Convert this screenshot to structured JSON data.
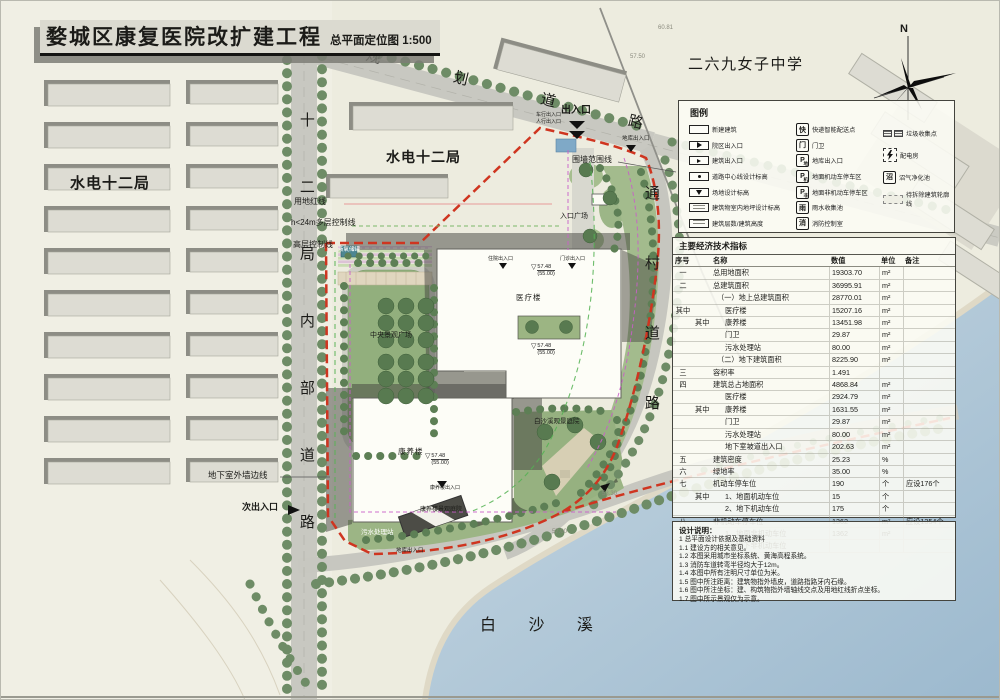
{
  "title": {
    "main": "婺城区康复医院改扩建工程",
    "sub": "总平面定位图 1:500"
  },
  "compass_label": "N",
  "map": {
    "areas": {
      "school": "二六九女子中学",
      "bureau_left": "水电十二局",
      "bureau_mid": "水电十二局",
      "river": "白 沙 溪",
      "planned_road": "规划道路",
      "internal_road": "十二局内部道路",
      "village_road": "通村道路"
    },
    "labels": {
      "main_entry": "出入口",
      "secondary_entry": "次出入口",
      "fence_line": "围墙范围线",
      "red_line": "用地红线",
      "multi_ctrl": "h<24m多层控制线",
      "high_ctrl": "高层控制线",
      "basement_edge": "地下室外墙边线",
      "plaza": "中央景观广场",
      "medical": "医疗楼",
      "care": "康养楼",
      "entry_plaza": "入口广场",
      "stream_garden": "白沙溪观景庭院",
      "care_garden": "康养楼景观庭院",
      "sewage": "污水处理站",
      "oxygen": "液氧储罐",
      "garage_entry": "地库出入口",
      "garage_entry2": "地库出入口",
      "entry_vehicle": "车行出入口",
      "entry_ped": "人行出入口",
      "entry_inpatient": "住院出入口",
      "entry_outpatient": "门诊出入口",
      "care_entry": "康养楼出入口",
      "elev_val": "57.48",
      "elev_ref": "(55.00)"
    },
    "spots": [
      "60.81",
      "57.50",
      "53.30",
      "57.00"
    ]
  },
  "legend": {
    "title": "图例",
    "col1": [
      {
        "icon": "newbuild",
        "label": "新建建筑"
      },
      {
        "icon": "entry_campus",
        "label": "院区出入口"
      },
      {
        "icon": "entry_bld",
        "label": "建筑出入口"
      },
      {
        "icon": "road_elev",
        "label": "道路中心线设计标高"
      },
      {
        "icon": "site_elev",
        "label": "场地设计标高"
      },
      {
        "icon": "floor_elev",
        "label": "建筑物室内地坪设计标高"
      },
      {
        "icon": "floors",
        "label": "建筑层数/建筑高度"
      }
    ],
    "col2": [
      {
        "glyph": "快",
        "label": "快递智能配送点"
      },
      {
        "glyph": "门",
        "label": "门卫"
      },
      {
        "glyph": "P",
        "sub": "地",
        "label": "地库出入口"
      },
      {
        "glyph": "P",
        "sub": "机",
        "label": "地面机动车停车区"
      },
      {
        "glyph": "P",
        "sub": "非",
        "label": "地面非机动车停车区"
      },
      {
        "glyph": "雨",
        "label": "雨水收集池"
      },
      {
        "glyph": "消",
        "label": "消防控制室"
      }
    ],
    "col3": [
      {
        "icon": "trash",
        "label": "垃圾收集点"
      },
      {
        "icon": "power",
        "label": "配电房"
      },
      {
        "glyph": "沼",
        "label": "沼气净化池"
      },
      {
        "icon": "demolish",
        "label": "待拆除建筑轮廓线"
      }
    ]
  },
  "table": {
    "title": "主要经济技术指标",
    "headers": [
      "序号",
      "名称",
      "数值",
      "单位",
      "备注"
    ],
    "rows": [
      {
        "no": "一",
        "sub": "",
        "name": "总用地面积",
        "val": "19303.70",
        "unit": "m²",
        "note": "",
        "ind": 0
      },
      {
        "no": "二",
        "sub": "",
        "name": "总建筑面积",
        "val": "36995.91",
        "unit": "m²",
        "note": "",
        "ind": 0
      },
      {
        "no": "",
        "sub": "",
        "name": "（一）地上总建筑面积",
        "val": "28770.01",
        "unit": "m²",
        "note": "",
        "ind": 1
      },
      {
        "no": "其中",
        "sub": "",
        "name": "医疗楼",
        "val": "15207.16",
        "unit": "m²",
        "note": "",
        "ind": 2
      },
      {
        "no": "",
        "sub": "其中",
        "name": "康养楼",
        "val": "13451.98",
        "unit": "m²",
        "note": "",
        "ind": 2
      },
      {
        "no": "",
        "sub": "",
        "name": "门卫",
        "val": "29.87",
        "unit": "m²",
        "note": "",
        "ind": 2
      },
      {
        "no": "",
        "sub": "",
        "name": "污水处理站",
        "val": "80.00",
        "unit": "m²",
        "note": "",
        "ind": 2
      },
      {
        "no": "",
        "sub": "",
        "name": "（二）地下建筑面积",
        "val": "8225.90",
        "unit": "m²",
        "note": "",
        "ind": 1
      },
      {
        "no": "三",
        "sub": "",
        "name": "容积率",
        "val": "1.491",
        "unit": "",
        "note": "",
        "ind": 0
      },
      {
        "no": "四",
        "sub": "",
        "name": "建筑总占地面积",
        "val": "4868.84",
        "unit": "m²",
        "note": "",
        "ind": 0
      },
      {
        "no": "",
        "sub": "",
        "name": "医疗楼",
        "val": "2924.79",
        "unit": "m²",
        "note": "",
        "ind": 2
      },
      {
        "no": "",
        "sub": "其中",
        "name": "康养楼",
        "val": "1631.55",
        "unit": "m²",
        "note": "",
        "ind": 2
      },
      {
        "no": "",
        "sub": "",
        "name": "门卫",
        "val": "29.87",
        "unit": "m²",
        "note": "",
        "ind": 2
      },
      {
        "no": "",
        "sub": "",
        "name": "污水处理站",
        "val": "80.00",
        "unit": "m²",
        "note": "",
        "ind": 2
      },
      {
        "no": "",
        "sub": "",
        "name": "地下室坡道出入口",
        "val": "202.63",
        "unit": "m²",
        "note": "",
        "ind": 2
      },
      {
        "no": "五",
        "sub": "",
        "name": "建筑密度",
        "val": "25.23",
        "unit": "%",
        "note": "",
        "ind": 0
      },
      {
        "no": "六",
        "sub": "",
        "name": "绿地率",
        "val": "35.00",
        "unit": "%",
        "note": "",
        "ind": 0
      },
      {
        "no": "七",
        "sub": "",
        "name": "机动车停车位",
        "val": "190",
        "unit": "个",
        "note": "应设176个",
        "ind": 0
      },
      {
        "no": "",
        "sub": "其中",
        "name": "1、地面机动车位",
        "val": "15",
        "unit": "个",
        "note": "",
        "ind": 2
      },
      {
        "no": "",
        "sub": "",
        "name": "2、地下机动车位",
        "val": "175",
        "unit": "个",
        "note": "",
        "ind": 2
      },
      {
        "no": "八",
        "sub": "",
        "name": "非机动车停车位",
        "val": "1362",
        "unit": "m²",
        "note": "应设1354个",
        "ind": 0
      },
      {
        "no": "",
        "sub": "",
        "name": "1、地面非机动车位",
        "val": "1362",
        "unit": "m²",
        "note": "",
        "ind": 2
      },
      {
        "no": "",
        "sub": "",
        "name": "2、地下非机动车位",
        "val": "",
        "unit": "",
        "note": "",
        "ind": 2
      }
    ]
  },
  "notes": {
    "title": "设计说明：",
    "lines": [
      "1 总平面设计依据及基础资料",
      "1.1 建设方的相关意见。",
      "1.2 本图采用城市坐标系统、黄海高程系统。",
      "1.3 消防车道转弯半径均大于12m。",
      "1.4 本图中所有注明尺寸单位为米。",
      "1.5 图中所注距离：建筑物指外墙皮，道路指路牙内石缘。",
      "1.6 图中所注坐标：建、构筑物指外墙轴线交点及用地红线折点坐标。",
      "1.7 图中所示景观仅为示意。"
    ]
  }
}
